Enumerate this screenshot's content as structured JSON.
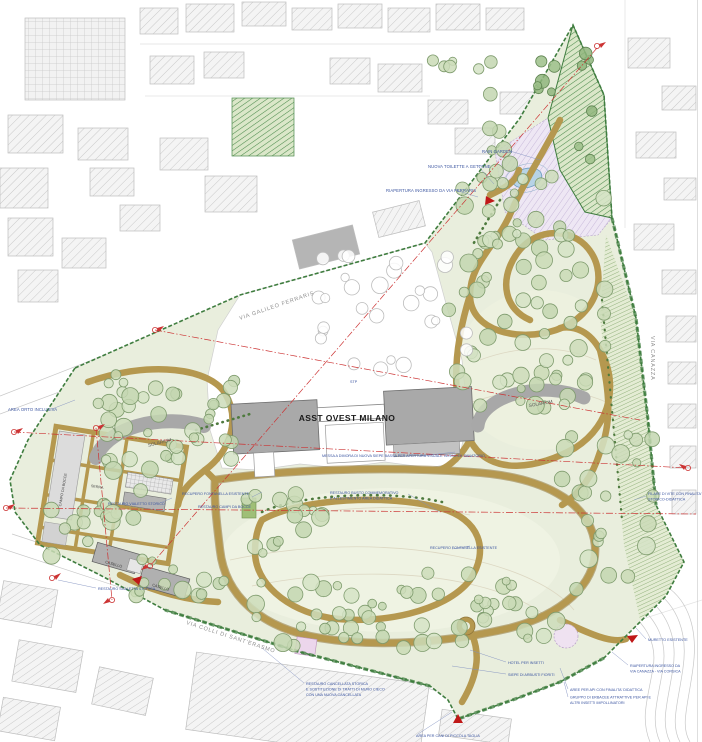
{
  "drawing": {
    "kind": "landscape masterplan site plan",
    "main_building": "ASST OVEST MILANO"
  },
  "labels": {
    "area_orto": "AREA ORTO INCLUSIVA",
    "rain_garden": "RAIN GARDEN",
    "nuova_toilette": "NUOVA TOILETTE A GETTONE",
    "riapertura_ferraris": "RIAPERTURA INGRESSO DA VIA FERRARIS",
    "stp": "STP",
    "asst": "ASST OVEST MILANO",
    "solarium_left": "SOLARIUM",
    "solarium_right": "SOLARIUM",
    "campo_bocce": "CAMPO DA BOCCE",
    "serra": "SERRA",
    "casello_1": "CASELLO",
    "casello_2": "CASELLO",
    "restauro_scaletta": "RESTAURO SCALETTA STORICA",
    "messa_dimora": "MESSA A DIMORA DI NUOVA SIEPE BASSA PER APERTURA VISUALE VERSO EX SANATORIO",
    "recupero_fontanella_1": "RECUPERO FONTANELLA ESISTENTE",
    "recupero_fontanella_2": "RECUPERO FONTANELLA ESISTENTE",
    "restauro_vialetto": "RESTAURO VIALETTO STORICO",
    "restauro_campi_bocce": "RESTAURO CAMPI DA BOCCE",
    "restauro_busto_1": "RESTAURO BUSTO COMMEMORATIVO",
    "restauro_busto_2": "E ALLESTIMENTO AREA DIDATTICA",
    "filare_vite_1": "FILARE DI VITE CON FINALITA'",
    "filare_vite_2": "STORICO-DIDATTICA",
    "hotel_insetti": "HOTEL PER INSETTI",
    "siepe_arbusti": "SIEPE DI ARBUSTI FIORITI",
    "aree_api": "AREE PER API CON FINALITA' DIDATTICA",
    "gruppo_erbacee_1": "GRUPPO DI ERBACEE ATTRATTIVE PER API E",
    "gruppo_erbacee_2": "ALTRI INSETTI IMPOLLINATORI",
    "muretto": "MURETTO ESISTENTE",
    "riapertura_sud_1": "RIAPERTURA INGRESSO DA",
    "riapertura_sud_2": "VIA CANAZZA - VIA CORSICA",
    "restauro_cancellata_1": "RESTAURO CANCELLATA STORICA",
    "restauro_cancellata_2": "E SOSTITUZIONE DI TRATTI DI MURO CIECO",
    "restauro_cancellata_3": "CON UNA NUOVA CANCELLATA",
    "area_cani": "AREA PER CANI DI PICCOLA TAGLIA"
  },
  "streets": {
    "via_ferraris": "VIA GALILEO FERRARIS",
    "via_colli": "VIA COLLI DI SANT'ERASMO",
    "via_canazza": "VIA CANAZZA"
  },
  "colors": {
    "park_green": "#e9eedd",
    "lawn_green": "#f0f3e3",
    "path_tan": "#b5984f",
    "boundary_green": "#3f7d3f",
    "building_gray": "#a9a9a9",
    "axis_red": "#cc3333",
    "water_blue": "#b7d3e6",
    "annotation_blue": "#3b55a0",
    "lavender": "#e6dcef",
    "hedge_green": "#4e8b4e"
  }
}
